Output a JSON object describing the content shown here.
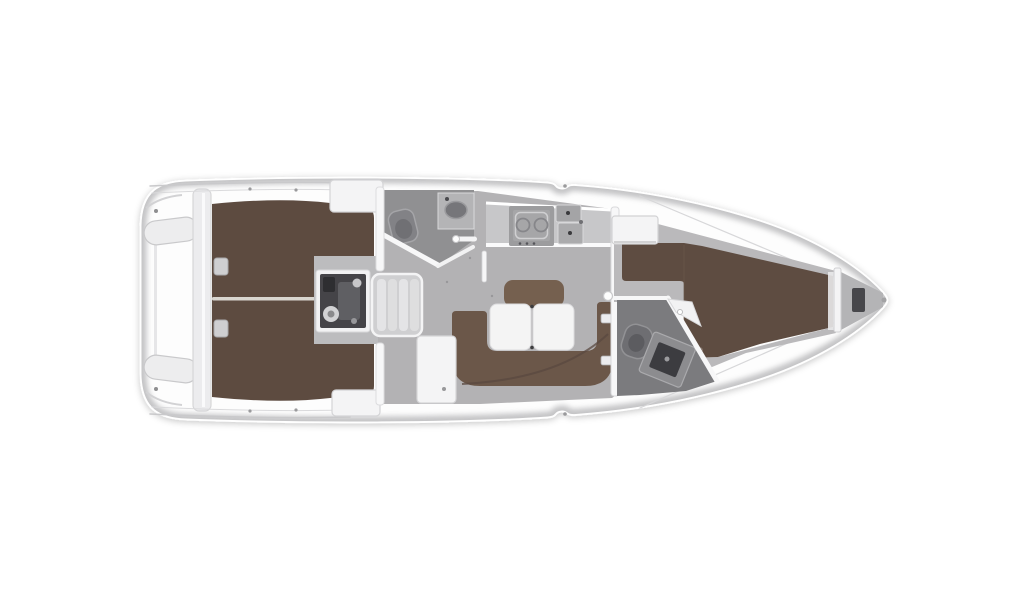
{
  "image": {
    "kind": "yacht-interior-floorplan",
    "orientation": "stern-left-bow-right",
    "background": "#ffffff"
  },
  "colors": {
    "background": "#ffffff",
    "hull_fill": "#fdfdfd",
    "hull_rim": "#bfbfc1",
    "deck_line": "#cccccd",
    "platform": "#ececee",
    "locker": "#f4f4f5",
    "salon_floor": "#b3b2b4",
    "fwd_floor": "#bab9bb",
    "head_floor_aft": "#909092",
    "head_floor_fwd": "#7b7b7e",
    "berth_aft": "#5d4b40",
    "berth_fwd": "#5e4c41",
    "berth_seam": "#d9d6d0",
    "settee": "#6b5749",
    "backrest": "#75604f",
    "table": "#f4f4f4",
    "counter": "#c7c7c9",
    "appliance": "#a6a6a8",
    "sink_basin": "#76767a",
    "engine_body": "#454448",
    "engine_frame": "#f2f2f3",
    "steps": "#cfcfd1",
    "step_tread": "#e4e4e6",
    "wall": "#f7f7f8",
    "wall_edge": "#d6d6d8",
    "fixture": "#8a8a8d",
    "fixture_dark": "#47474b",
    "anchor_locker": "#b4b4b6"
  },
  "regions": [
    "transom-swim-platform",
    "stern-seats",
    "aft-cabin-double-berth",
    "engine-compartment",
    "companionway-steps",
    "aft-head-bathroom",
    "galley",
    "salon-u-settee",
    "salon-table",
    "nav-cabinet",
    "forward-head-bathroom",
    "forward-cabin-v-berth",
    "wardrobe",
    "anchor-locker"
  ]
}
